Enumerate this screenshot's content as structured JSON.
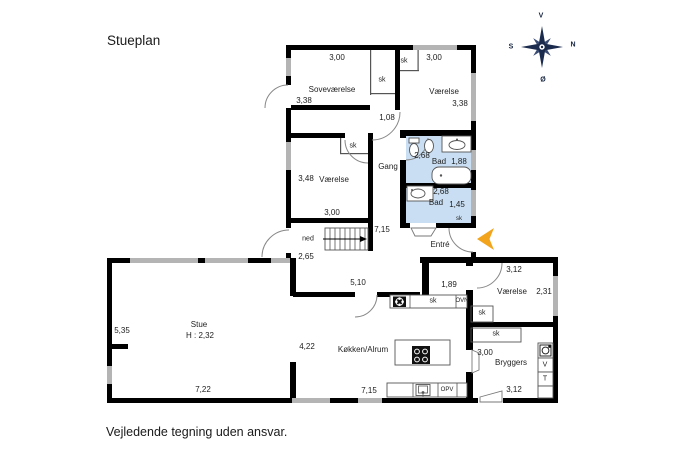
{
  "page": {
    "title": "Stueplan",
    "disclaimer": "Vejledende tegning uden ansvar."
  },
  "compass": {
    "top": "V",
    "right": "N",
    "left": "S",
    "bottom": "Ø"
  },
  "colors": {
    "wall": "#000000",
    "window": "#b4b4b4",
    "bath_fill": "#c9def2",
    "entry_arrow": "#f2a51c",
    "compass": "#1b2b4d"
  },
  "plan": {
    "upper": {
      "sovevaerelse": {
        "name": "Soveværelse",
        "dim_top": "3,00",
        "dim_left": "3,38",
        "closet": "sk",
        "door_dim": "1,08"
      },
      "vaerelse_ne": {
        "name": "Værelse",
        "dim_top": "3,00",
        "dim_right": "3,38",
        "closet": "sk"
      },
      "gang": {
        "name": "Gang",
        "closet": "sk"
      },
      "bad1": {
        "name": "Bad",
        "dim_top": "2,68",
        "dim_right": "1,88"
      },
      "bad2": {
        "name": "Bad",
        "dim_top": "2,68",
        "dim_right": "1,45",
        "closet": "sk"
      },
      "entre": {
        "name": "Entré"
      },
      "vaerelse_w": {
        "name": "Værelse",
        "dim_left": "3,48",
        "dim_bottom": "3,00"
      },
      "stairs": {
        "direction": "ned"
      },
      "dim_width": "7,15",
      "dim_left": "2,65"
    },
    "lower": {
      "stue": {
        "name": "Stue",
        "ceiling_height": "H : 2,32",
        "dim_left": "5,35",
        "dim_bottom": "7,22"
      },
      "koekken": {
        "name": "Køkken/Alrum",
        "dim_top": "5,10",
        "dim_entry": "1,89",
        "dim_left": "4,22",
        "dim_bottom": "7,15",
        "closet": "sk",
        "oven": "OVN",
        "dishwasher": "OPV"
      },
      "vaerelse_e": {
        "name": "Værelse",
        "dim_top": "3,12",
        "dim_right": "2,31",
        "closet": "sk"
      },
      "bryggers": {
        "name": "Bryggers",
        "dim_left": "3,00",
        "dim_bottom": "3,12",
        "closet": "sk",
        "washer": "V",
        "dryer": "T"
      }
    }
  }
}
